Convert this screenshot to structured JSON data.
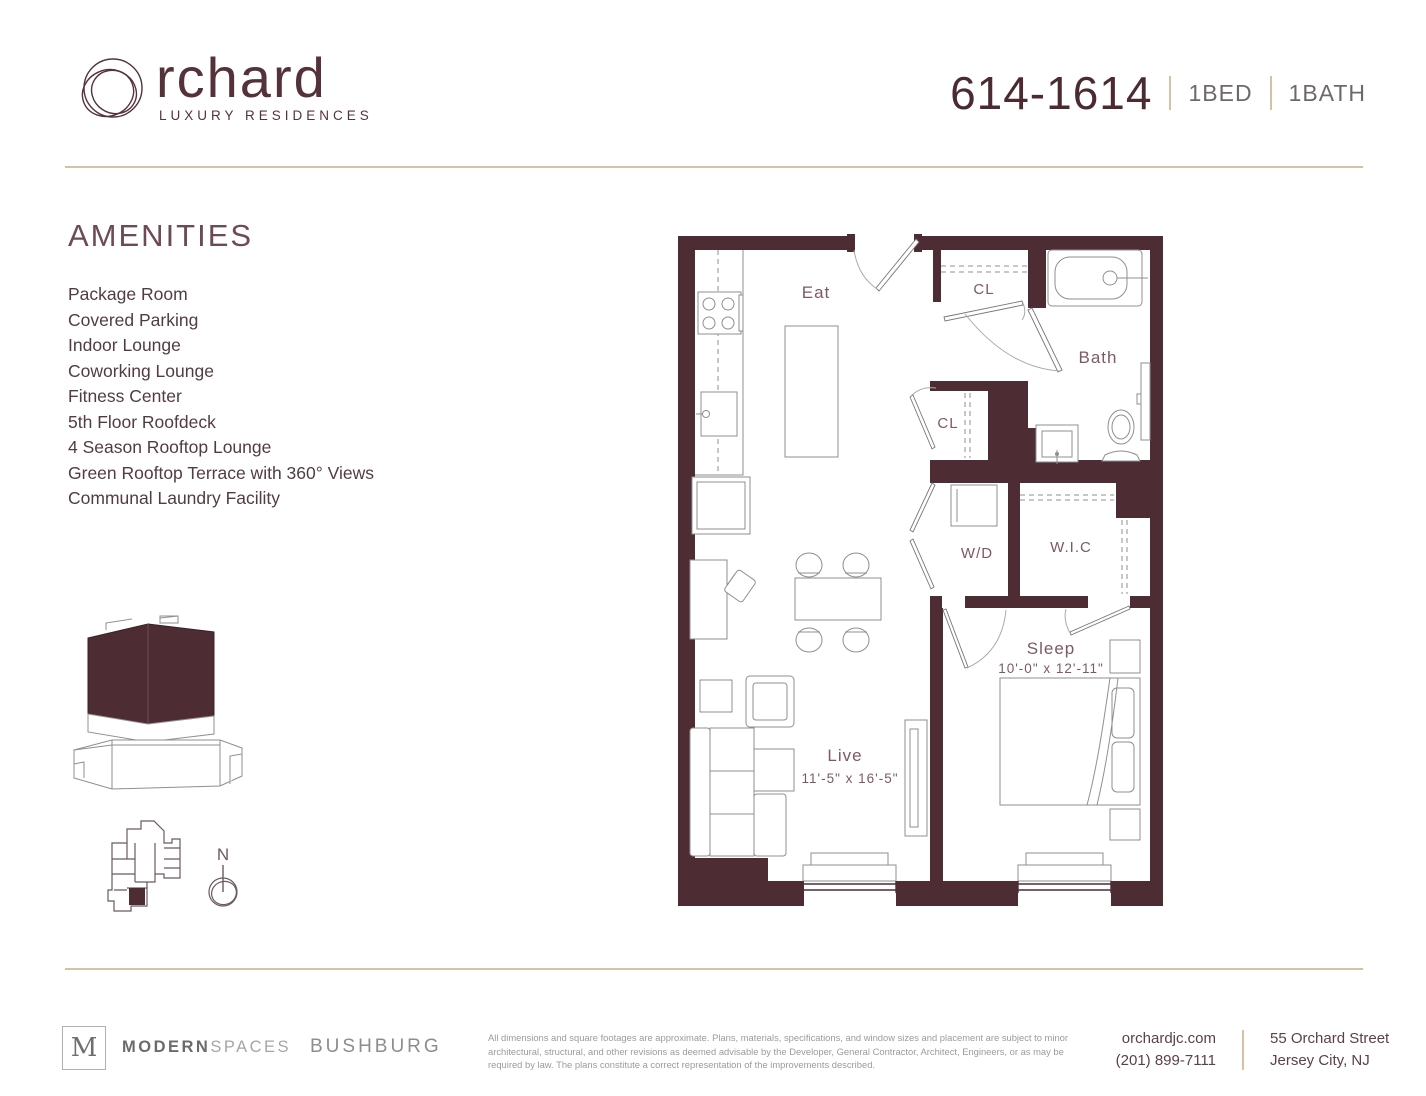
{
  "brand": {
    "name": "rchard",
    "tagline": "LUXURY RESIDENCES"
  },
  "header": {
    "unit": "614-1614",
    "bed": "1BED",
    "bath": "1BATH"
  },
  "amenities": {
    "title": "AMENITIES",
    "items": [
      "Package Room",
      "Covered Parking",
      "Indoor Lounge",
      "Coworking Lounge",
      "Fitness Center",
      "5th Floor Roofdeck",
      "4 Season Rooftop Lounge",
      "Green Rooftop Terrace with 360° Views",
      "Communal Laundry Facility"
    ]
  },
  "floor_plan": {
    "labels": {
      "eat": "Eat",
      "closet_top": "CL",
      "bath": "Bath",
      "closet_mid": "CL",
      "washer_dryer": "W/D",
      "walk_in_closet": "W.I.C",
      "sleep": "Sleep",
      "sleep_dims": "10'-0\" x 12'-11\"",
      "live": "Live",
      "live_dims": "11'-5\" x 16'-5\""
    },
    "north_label": "N"
  },
  "footer": {
    "broker_logo_letter": "M",
    "broker_name_bold": "MODERN",
    "broker_name_light": "SPACES",
    "developer": "BUSHBURG",
    "disclaimer": "All dimensions and square footages are approximate. Plans, materials, specifications, and window sizes and placement are subject to minor architectural, structural, and other revisions as deemed advisable by the Developer, General Contractor, Architect, Engineers, or as may be required by law. The plans constitute a correct representation of the improvements described.",
    "website": "orchardjc.com",
    "phone": "(201) 899-7111",
    "address_line1": "55 Orchard Street",
    "address_line2": "Jersey City, NJ"
  },
  "colors": {
    "wall_maroon": "#4e2c33",
    "plan_label": "#7d5a61",
    "tan_divider": "#d9c0a2",
    "line_gray": "#8f8f8f"
  }
}
